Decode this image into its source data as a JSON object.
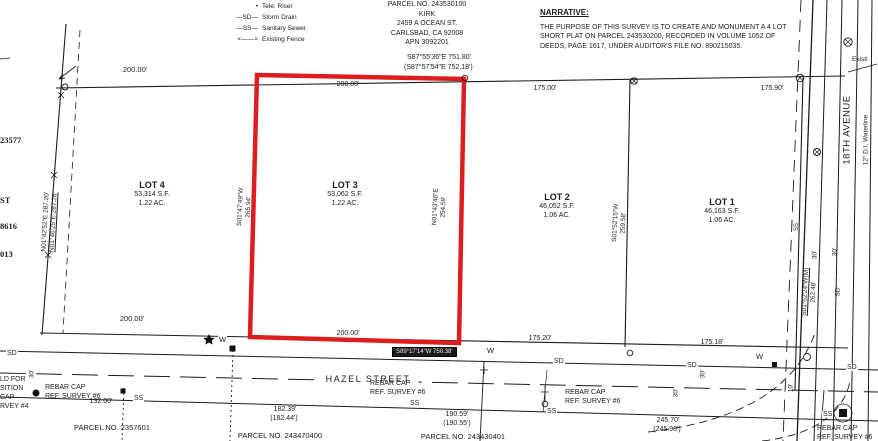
{
  "legend": {
    "items": [
      {
        "symbol": "•",
        "label": "Tele. Riser"
      },
      {
        "symbol": "—SD—",
        "label": "Storm Drain"
      },
      {
        "symbol": "—SS—",
        "label": "Sanitary Sewer"
      },
      {
        "symbol": "×——×",
        "label": "Existing Fence"
      }
    ]
  },
  "owner_block": {
    "parcel_no": "PARCEL NO. 243530100",
    "name": "KIRK",
    "address": "2459 A OCEAN ST.",
    "city": "CARLSBAD, CA  92008",
    "apn": "APN 3092201"
  },
  "narrative": {
    "title": "NARRATIVE:",
    "body": "THE PURPOSE OF THIS SURVEY IS TO CREATE AND MONUMENT A 4 LOT SHORT PLAT ON PARCEL 243530200, RECORDED IN VOLUME 1052 OF DEEDS, PAGE 1617, UNDER AUDITOR'S FILE NO. 890215035."
  },
  "lots": [
    {
      "name": "LOT 1",
      "area_sf": "46,163 S.F.",
      "area_ac": "1.06 AC."
    },
    {
      "name": "LOT 2",
      "area_sf": "46,052 S.F.",
      "area_ac": "1.06 AC."
    },
    {
      "name": "LOT 3",
      "area_sf": "53,062 S.F.",
      "area_ac": "1.22 AC."
    },
    {
      "name": "LOT 4",
      "area_sf": "53,314 S.F.",
      "area_ac": "1.22 AC."
    }
  ],
  "dims": {
    "top_200_west": "200.00'",
    "top_bearing": "S87°55'36\"E   751.80'",
    "top_bearing_record": "(S87°57'54\"E 752.18')",
    "top_200_lot3": "200.00'",
    "top_175_lot2": "175.00'",
    "top_175_lot1": "175.90'",
    "bot_200_west": "200.00'",
    "bot_200_lot3": "200.00'",
    "bot_175_lot2": "175.20'",
    "bot_175_lot1": "175.18'",
    "bot_bearing_boxed": "S89°17'14\"W  750.38'",
    "low_132": "132.00'",
    "low_182": "182.39'",
    "low_182_r": "(182.44')",
    "low_190": "190.59'",
    "low_190_r": "(190.55')",
    "low_245": "245.70'",
    "low_245_r": "(245.90')"
  },
  "bearings": {
    "west_fence": "N01°42'52\"E 287.20'",
    "west_fence_record": "N01°46'25\"E 287.26'",
    "lot4_lot3": "S01°47'49\"W",
    "lot4_lot3_dist": "265.94'",
    "lot3_lot2": "N01°43'46\"E",
    "lot3_lot2_dist": "254.59'",
    "lot2_lot1": "S01°52'15\"W",
    "lot2_lot1_dist": "259.58'",
    "east": "S01°52'24\"W(M)",
    "east_dist": "262.48'"
  },
  "streets": {
    "hazel": "HAZEL STREET",
    "avenue": "18TH AVENUE",
    "waterline": "12\" D.I. Waterline",
    "existing_cut": "Existi"
  },
  "offsets": {
    "o30": "30'",
    "o10": "10'"
  },
  "markers": {
    "sd": "SD",
    "ss": "SS",
    "w": "W"
  },
  "rebar": {
    "cap": "REBAR CAP",
    "ref6": "REF. SURVEY #6"
  },
  "held_fragments": [
    "LD FOR",
    "SITION",
    "CAP",
    "RVEY #4"
  ],
  "edge_fragments": [
    "23577",
    "ST",
    "8616",
    "013"
  ],
  "parcels_bottom": [
    "PARCEL NO. 2357601",
    "PARCEL NO. 243470400",
    "PARCEL NO. 243430401"
  ]
}
